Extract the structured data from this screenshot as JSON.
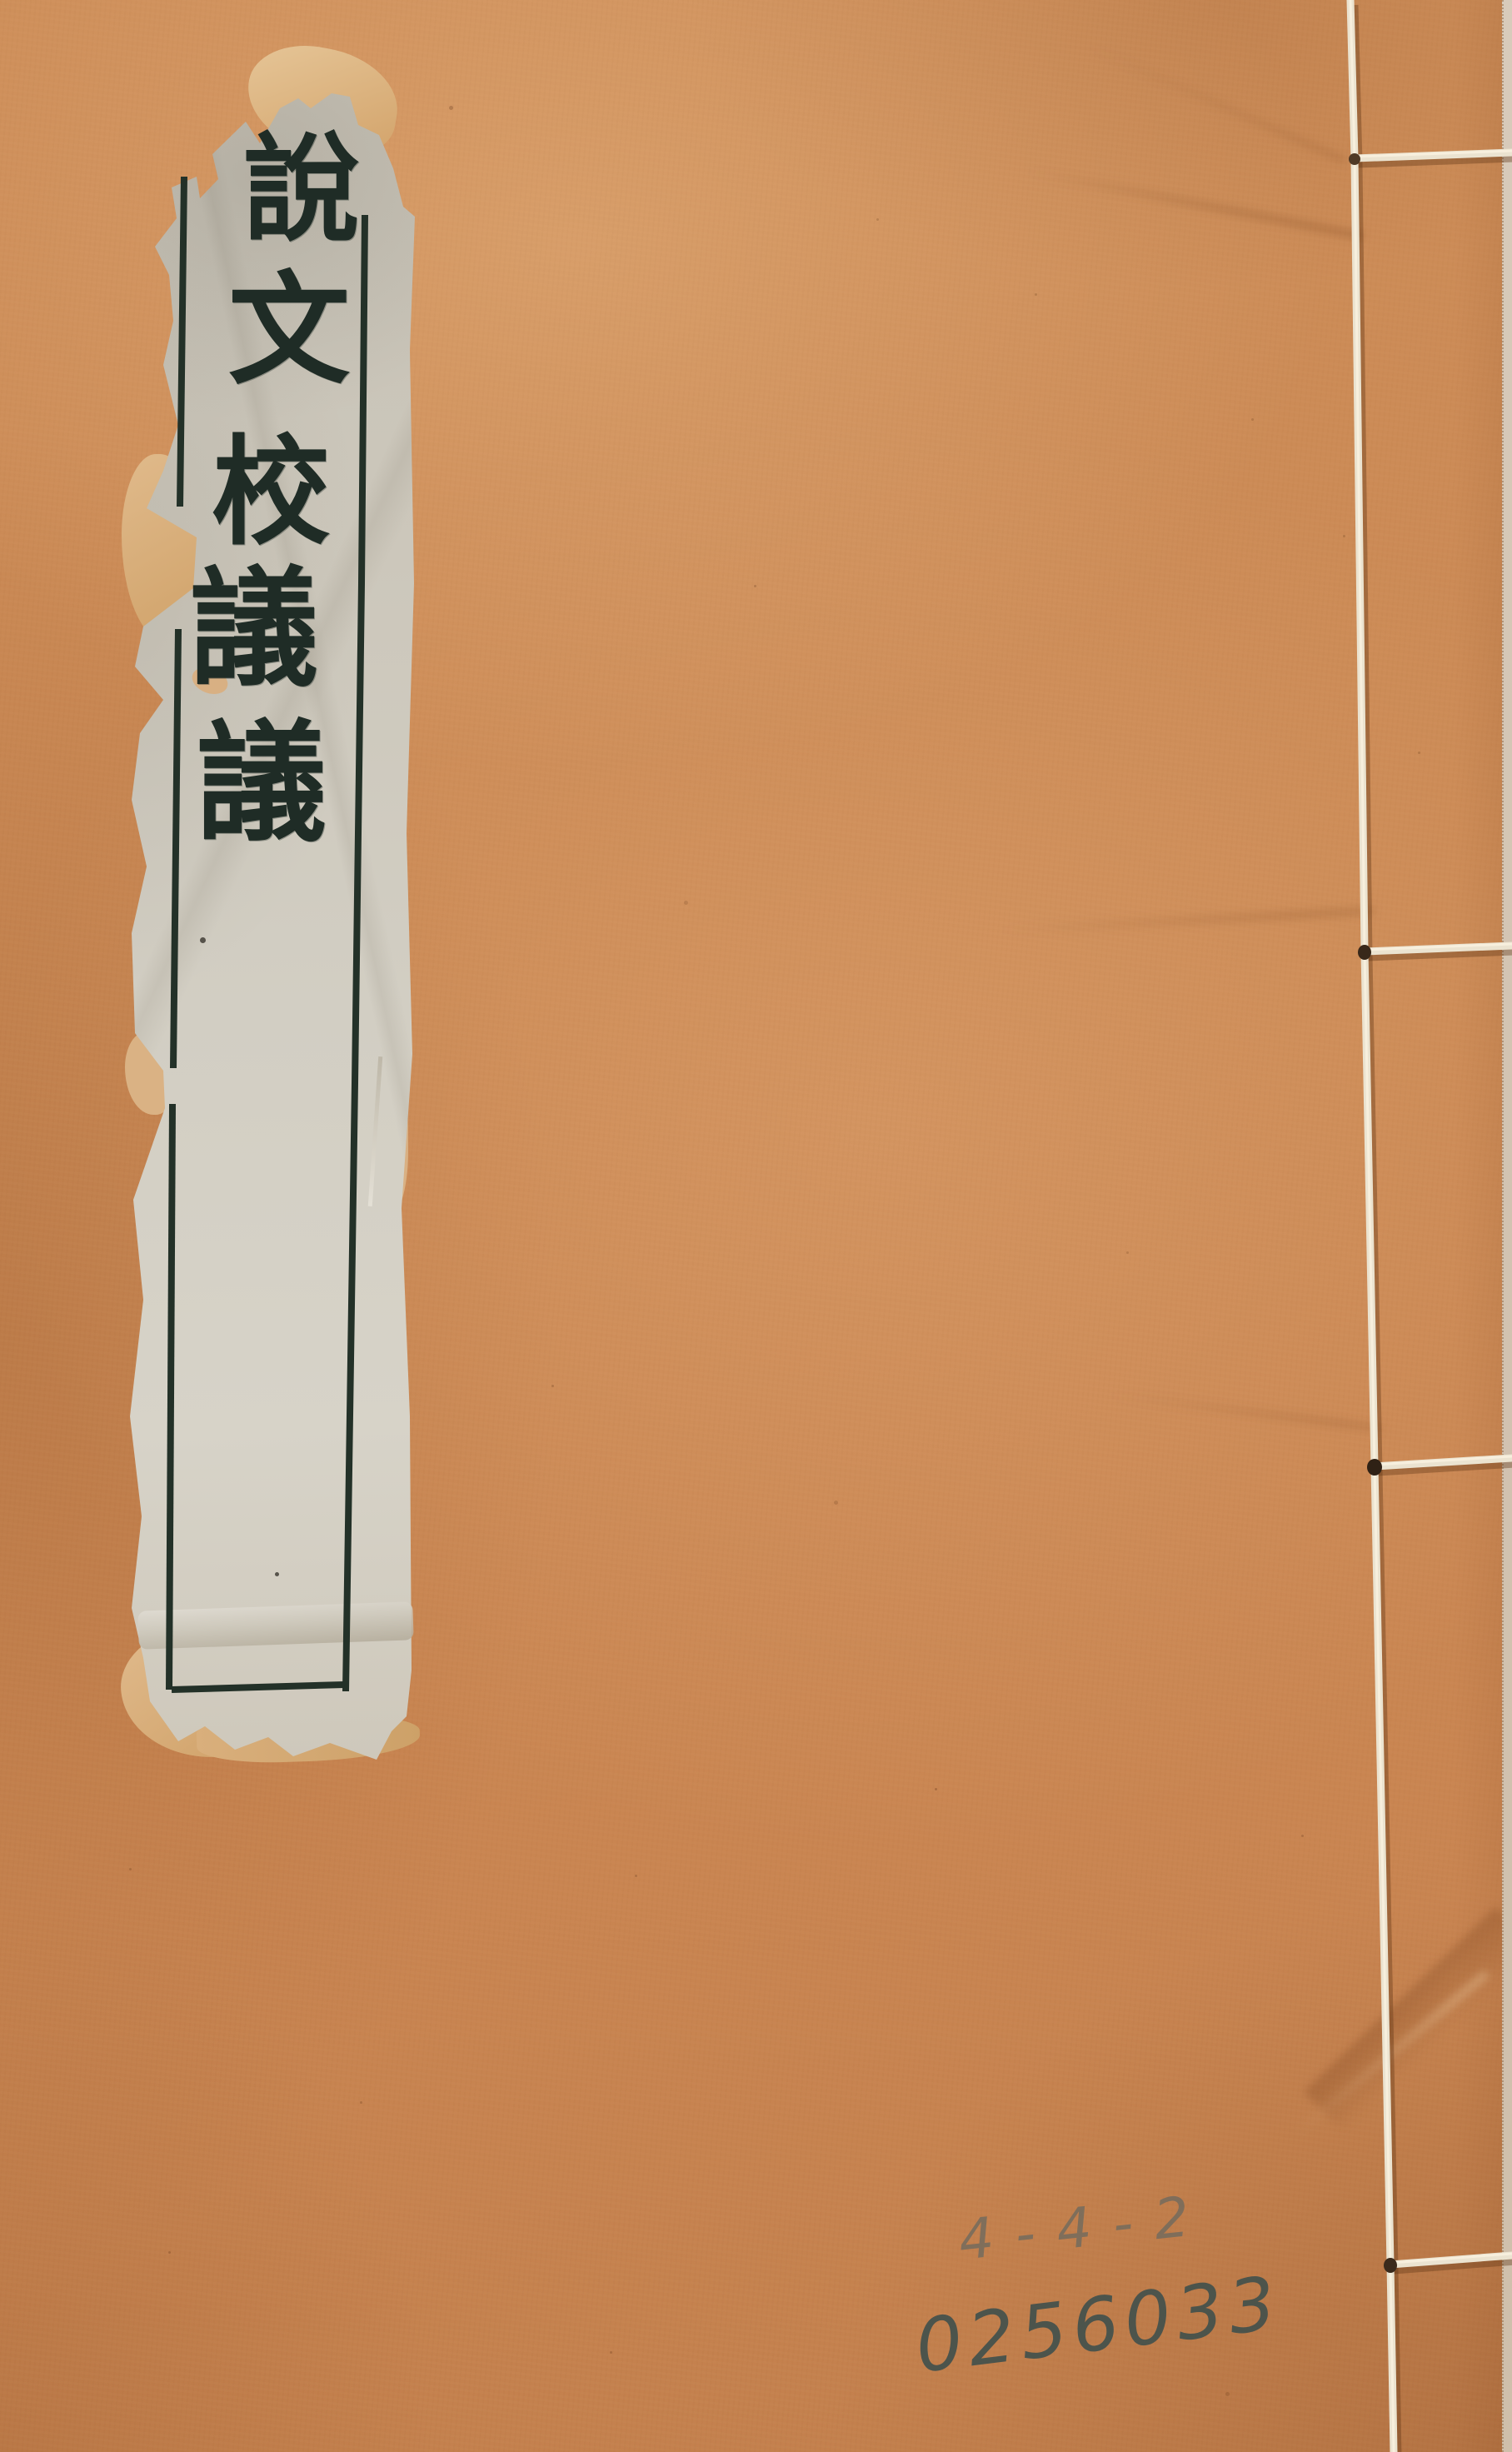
{
  "cover": {
    "title_label": {
      "title": "說文校議議",
      "chars": [
        "說",
        "文",
        "校",
        "議",
        "議"
      ]
    },
    "handwritten": {
      "sequence": "4-4-2",
      "call_number": "0256033"
    },
    "colors": {
      "cover_paper": "#cb8a55",
      "label_paper": "#d0ccc1",
      "label_frame_ink": "#233128",
      "title_ink": "#1f2c26",
      "torn_backing": "#d9b083",
      "binding_thread": "#ebe3d0",
      "pencil_gray": "#706a5e",
      "call_number_ink": "#42504c"
    }
  }
}
